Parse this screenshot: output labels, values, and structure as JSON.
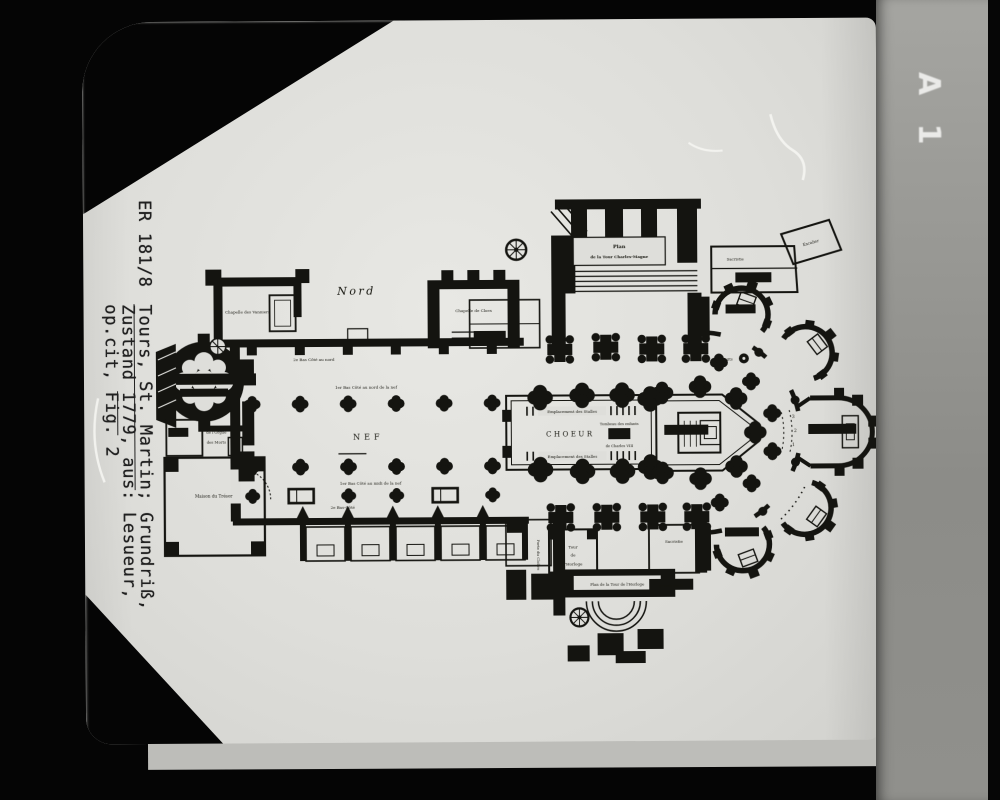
{
  "film_label": "A 1",
  "caption": {
    "catalog_no": "ER 181/8",
    "title_underlined": "Tours, St. Martin",
    "title_rest": "; Grundriß,",
    "line2_pre": "Zustand ",
    "line2_underlined": "1779",
    "line2_post": ", aus: Lesueur,",
    "line3": "op.cit, Fig. 2"
  },
  "plan": {
    "labels": {
      "nord": "Nord",
      "nef": "NEF",
      "choeur": "CHOEUR",
      "sanctuaire": "SANCTUAIRE",
      "stalles_top": "Emplacement des Stalles",
      "stalles_bottom": "Emplacement des Stalles",
      "tombeau_line1": "Tombeau des enfants",
      "tombeau_line2": "de Charles VIII",
      "tour_charlemagne_line1": "Plan",
      "tour_charlemagne_line2": "de la Tour Charles-Magne",
      "tour_horloge_plaque": "Plan de la Tour de l'Horloge",
      "tour_room_line1": "Tour",
      "tour_room_line2": "de",
      "tour_room_line3": "l'Horloge",
      "chapelle_vierge": "Chapelle de la Vierge",
      "chapelle_vanniers": "Chapelle des Vanniers",
      "chapelle_tour_line1": "Chapelle St Nicolas",
      "chapelle_tour_line2": "de la vieille Tour",
      "chapelle_cloes": "Chapelle de Cloes",
      "chapelle_nord_est": "Chapelle",
      "chapelle_sud_est": "Chapelle",
      "maison_tresor": "Maison du Trésor",
      "escalier_a": "Escalier",
      "escalier_b": "Escalier",
      "escalier_c": "Escalier",
      "sacristie_nord": "Sacristie",
      "sacristie_sud": "Sacristie",
      "grande_porte": "grande porte",
      "puits": "Puits",
      "porte_ouest": "Porte",
      "porte_sud": "Porte",
      "porte_cloitre": "Porte du Cloître",
      "orgue_line1": "de l'Orgue",
      "orgue_line2": "des Morts",
      "bas_cote_nord_1": "1er Bas Côté au nord de la nef",
      "bas_cote_nord_2": "2e Bas Côté au nord",
      "bas_cote_midi_1": "1er Bas Côté au midi de la nef",
      "bas_cote_midi_2": "2e Bas-Côté",
      "step_1": "1",
      "step_2": "2",
      "step_3": "3"
    }
  }
}
